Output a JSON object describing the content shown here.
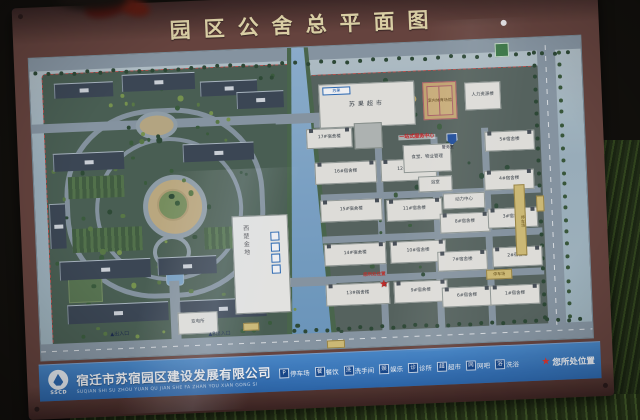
{
  "colors": {
    "frame": "#6b453c",
    "bar_blue": "#2e6cb4",
    "boundary_red": "#c6514a",
    "star_red": "#cf2a24",
    "water": "#7aa4c8"
  },
  "board": {
    "title": "园区公舍总平面图"
  },
  "bottom_bar": {
    "logo_text": "SSCD",
    "company": "宿迁市苏宿园区建设发展有限公司",
    "pinyin": "SUQIAN SHI SU ZHOU YUAN QU JIAN SHE FA ZHAN YOU XIAN GONG SI",
    "legend": [
      {
        "icon": "parking-icon",
        "glyph": "P",
        "label": "停车场"
      },
      {
        "icon": "dining-icon",
        "glyph": "餐",
        "label": "餐饮"
      },
      {
        "icon": "restroom-icon",
        "glyph": "洗",
        "label": "洗手间"
      },
      {
        "icon": "entertainment-icon",
        "glyph": "娱",
        "label": "娱乐"
      },
      {
        "icon": "clinic-icon",
        "glyph": "诊",
        "label": "诊所"
      },
      {
        "icon": "supermarket-icon",
        "glyph": "超",
        "label": "超市"
      },
      {
        "icon": "internet-cafe-icon",
        "glyph": "网",
        "label": "网吧"
      },
      {
        "icon": "bath-icon",
        "glyph": "浴",
        "label": "洗浴"
      }
    ],
    "location": {
      "star": "★",
      "label": "您所处位置"
    }
  },
  "map": {
    "dorm_buildings": [
      {
        "label": "17#宿舍楼",
        "x": 274,
        "y": 82,
        "w": 46,
        "h": 20
      },
      {
        "label": "16#宿舍楼",
        "x": 281,
        "y": 116,
        "w": 62,
        "h": 22
      },
      {
        "label": "15#宿舍楼",
        "x": 285,
        "y": 154,
        "w": 62,
        "h": 22
      },
      {
        "label": "14#宿舍楼",
        "x": 287,
        "y": 198,
        "w": 62,
        "h": 22
      },
      {
        "label": "13#宿舍楼",
        "x": 287,
        "y": 238,
        "w": 64,
        "h": 22
      },
      {
        "label": "12#宿舍楼",
        "x": 347,
        "y": 116,
        "w": 56,
        "h": 22
      },
      {
        "label": "11#宿舍楼",
        "x": 351,
        "y": 156,
        "w": 56,
        "h": 22
      },
      {
        "label": "10#宿舍楼",
        "x": 353,
        "y": 198,
        "w": 56,
        "h": 22
      },
      {
        "label": "9#宿舍楼",
        "x": 355,
        "y": 238,
        "w": 54,
        "h": 22
      },
      {
        "label": "8#宿舍楼",
        "x": 404,
        "y": 172,
        "w": 50,
        "h": 20
      },
      {
        "label": "7#宿舍楼",
        "x": 400,
        "y": 210,
        "w": 50,
        "h": 20
      },
      {
        "label": "6#宿舍楼",
        "x": 403,
        "y": 246,
        "w": 50,
        "h": 20
      },
      {
        "label": "5#宿舍楼",
        "x": 452,
        "y": 92,
        "w": 50,
        "h": 20
      },
      {
        "label": "4#宿舍楼",
        "x": 450,
        "y": 131,
        "w": 50,
        "h": 20
      },
      {
        "label": "3#宿舍楼",
        "x": 452,
        "y": 169,
        "w": 50,
        "h": 20
      },
      {
        "label": "2#宿舍楼",
        "x": 455,
        "y": 208,
        "w": 50,
        "h": 20
      },
      {
        "label": "1#宿舍楼",
        "x": 451,
        "y": 246,
        "w": 50,
        "h": 20
      }
    ],
    "facilities": [
      {
        "name": "supermarket-building",
        "label": "苏果超市",
        "logo": "苏果",
        "x": 288,
        "y": 38,
        "w": 96,
        "h": 44,
        "cls": "market"
      },
      {
        "name": "hr-building",
        "label": "人力资源楼",
        "x": 434,
        "y": 42,
        "w": 36,
        "h": 28,
        "cls": ""
      },
      {
        "name": "canteen-property-building",
        "label": "食堂、物业管理",
        "x": 370,
        "y": 102,
        "w": 48,
        "h": 28,
        "cls": ""
      },
      {
        "name": "bath-house",
        "label": "浴室",
        "x": 384,
        "y": 134,
        "w": 34,
        "h": 16,
        "cls": ""
      },
      {
        "name": "power-center",
        "label": "动力中心",
        "x": 408,
        "y": 152,
        "w": 42,
        "h": 16,
        "cls": ""
      },
      {
        "name": "substation",
        "label": "变电所",
        "x": 138,
        "y": 260,
        "w": 40,
        "h": 22,
        "cls": ""
      }
    ],
    "sports_courts": {
      "label": "室内体育场馆",
      "x": 392,
      "y": 40,
      "w": 34,
      "h": 38
    },
    "commercial_building": {
      "label": "西楚金地",
      "x": 196,
      "y": 166,
      "w": 56,
      "h": 98,
      "icons": [
        "restroom-icon",
        "dining-icon",
        "clinic-icon",
        "shopping-icon"
      ]
    },
    "service_center_label": "一站式服务中心",
    "police_label": "警务室",
    "parking_strip_label": "停车场",
    "parking_chip_label": "停车场",
    "you_are_here": {
      "star": "★",
      "label": "您所处位置",
      "x": 341,
      "y": 236
    },
    "entrances": [
      {
        "label": "▲出入口",
        "x": 70,
        "y": 277
      },
      {
        "label": "▲B出入口",
        "x": 168,
        "y": 281
      }
    ],
    "apartment_blocks": [
      {
        "x": 24,
        "y": 26,
        "w": 58,
        "h": 14
      },
      {
        "x": 92,
        "y": 20,
        "w": 72,
        "h": 16
      },
      {
        "x": 170,
        "y": 30,
        "w": 56,
        "h": 14
      },
      {
        "x": 206,
        "y": 42,
        "w": 46,
        "h": 16
      },
      {
        "x": 20,
        "y": 96,
        "w": 70,
        "h": 17
      },
      {
        "x": 150,
        "y": 92,
        "w": 70,
        "h": 17
      },
      {
        "x": 14,
        "y": 146,
        "w": 15,
        "h": 44
      },
      {
        "x": 22,
        "y": 204,
        "w": 90,
        "h": 18
      },
      {
        "x": 120,
        "y": 204,
        "w": 58,
        "h": 17
      },
      {
        "x": 28,
        "y": 248,
        "w": 100,
        "h": 18
      },
      {
        "x": 140,
        "y": 248,
        "w": 86,
        "h": 18
      }
    ]
  }
}
